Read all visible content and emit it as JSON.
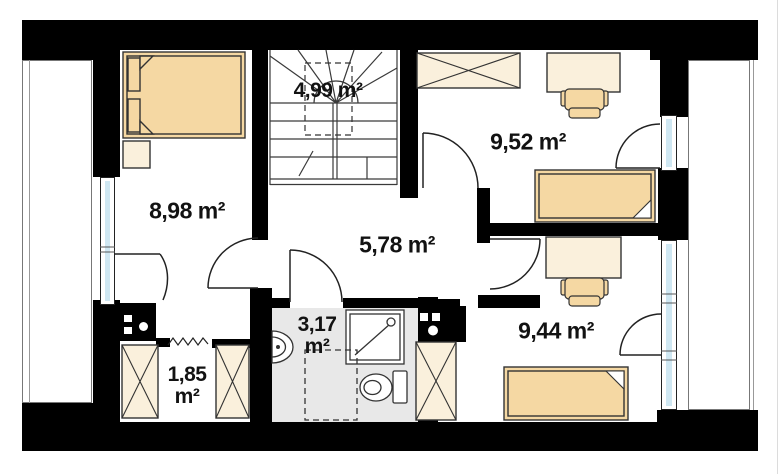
{
  "plan": {
    "type": "attic-floor-plan",
    "rooms": [
      {
        "id": "bedroom-left",
        "area": "8,98 m²"
      },
      {
        "id": "staircase",
        "area": "4,99 m²"
      },
      {
        "id": "room-top-right",
        "area": "9,52 m²"
      },
      {
        "id": "hallway",
        "area": "5,78 m²"
      },
      {
        "id": "closet",
        "area_line1": "1,85",
        "area_line2": "m²"
      },
      {
        "id": "bathroom",
        "area_line1": "3,17",
        "area_line2": "m²"
      },
      {
        "id": "room-bottom-right",
        "area": "9,44 m²"
      }
    ],
    "symbols": [
      "double-bed",
      "nightstand",
      "wardrobe",
      "desk",
      "chair",
      "single-bed",
      "shower",
      "toilet",
      "washbasin",
      "chimney-flue",
      "stairs",
      "door-swing",
      "window"
    ],
    "colors": {
      "wall": "#000000",
      "furniture_light": "#faf0dc",
      "furniture_tan": "#f5d8a3",
      "window_glass": "#cfe7f2",
      "bathroom_floor": "#e8e8e8",
      "line": "#333333",
      "label_text": "#121212"
    }
  }
}
